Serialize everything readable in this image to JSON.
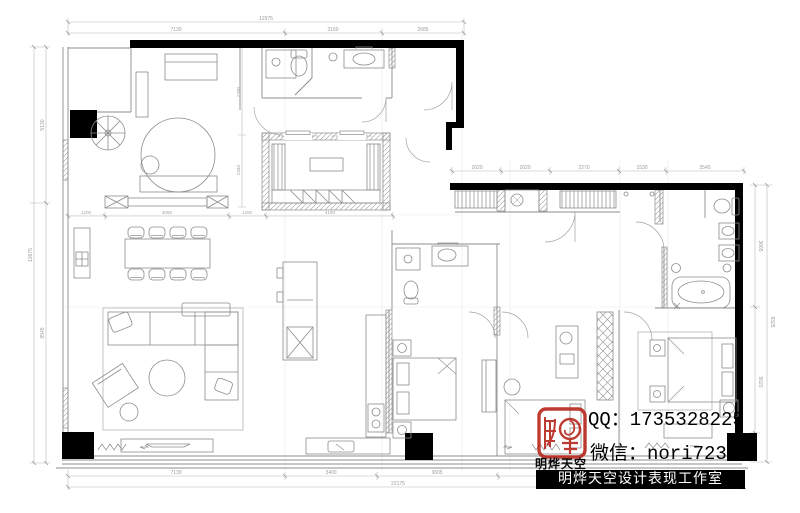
{
  "watermark": {
    "qq": "QQ：1735328225",
    "wechat": "微信：nori723",
    "brand": "明烨天空",
    "studio_banner": "明烨天空设计表现工作室",
    "stamp_color": "#b92b20"
  },
  "dimensions": {
    "top": {
      "overall": "12975",
      "segments": [
        "7130",
        "3160",
        "2685"
      ]
    },
    "top_inner_row": {
      "segments": [
        "1200",
        "4050",
        "1200",
        "4160"
      ]
    },
    "right_wing_top": {
      "segments": [
        "1620",
        "1620",
        "2270",
        "1530",
        "2545"
      ]
    },
    "left": {
      "overall": "13675",
      "segments": [
        "5130",
        "8545"
      ]
    },
    "left_inner_vertical": {
      "segments": [
        "2790",
        "2340"
      ]
    },
    "right": {
      "overall": "8325",
      "segments": [
        "3665",
        "5020"
      ]
    },
    "bottom": {
      "overall": "22175",
      "segments": [
        "7130",
        "3400",
        "3605"
      ]
    }
  },
  "plan": {
    "wall_color": "#000000",
    "line_color": "#8c8c8c",
    "dim_color": "#b0b0b0"
  }
}
